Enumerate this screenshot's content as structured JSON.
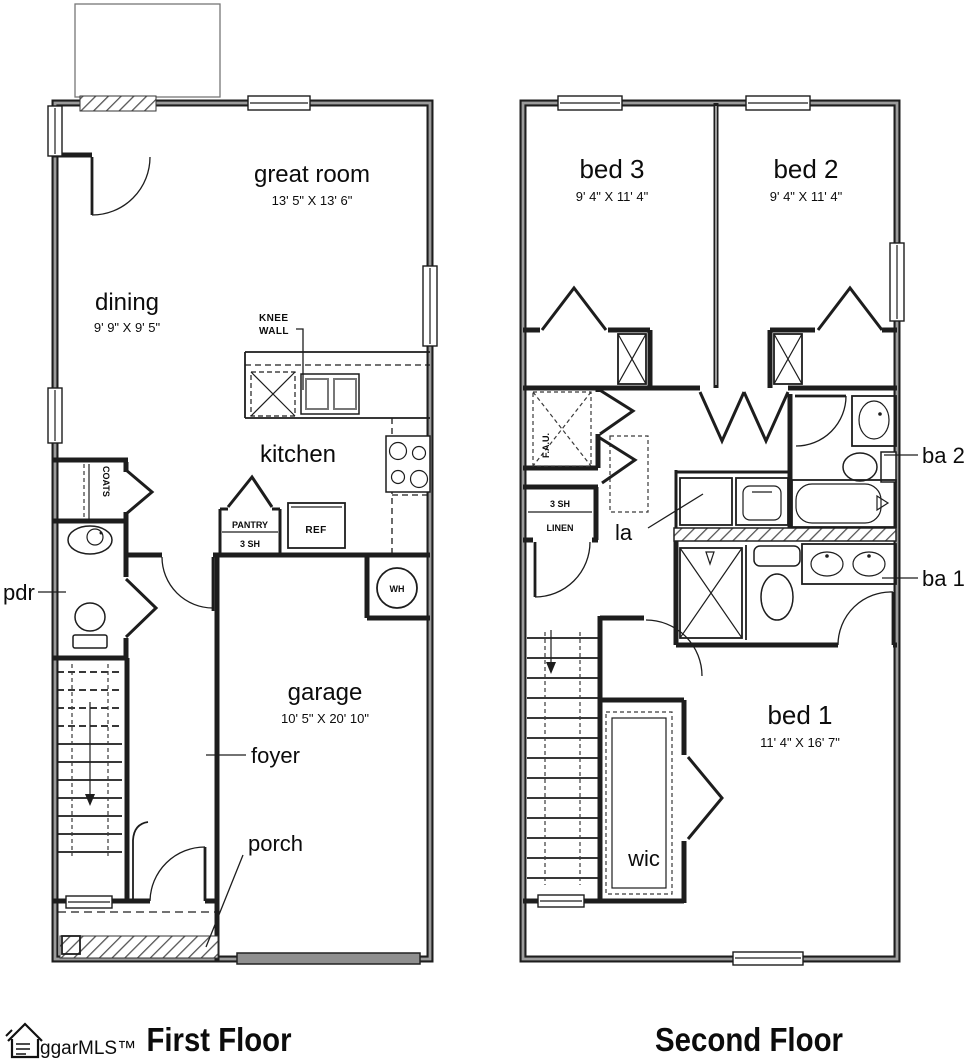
{
  "first_floor": {
    "title": "First Floor",
    "great_room": {
      "name": "great room",
      "dims": "13' 5\" X 13' 6\""
    },
    "dining": {
      "name": "dining",
      "dims": "9' 9\" X 9' 5\""
    },
    "kitchen": {
      "name": "kitchen"
    },
    "garage": {
      "name": "garage",
      "dims": "10' 5\" X 20' 10\""
    },
    "foyer": {
      "name": "foyer"
    },
    "porch": {
      "name": "porch"
    },
    "pdr": {
      "name": "pdr"
    },
    "knee_wall": [
      "KNEE",
      "WALL"
    ],
    "coats": "COATS",
    "pantry": [
      "PANTRY",
      "3 SH"
    ],
    "ref": "REF",
    "wh": "WH"
  },
  "second_floor": {
    "title": "Second Floor",
    "bed_3": {
      "name": "bed 3",
      "dims": "9' 4\" X 11' 4\""
    },
    "bed_2": {
      "name": "bed 2",
      "dims": "9' 4\" X 11' 4\""
    },
    "bed_1": {
      "name": "bed 1",
      "dims": "11' 4\" X 16' 7\""
    },
    "wic": {
      "name": "wic"
    },
    "ba_2": {
      "name": "ba 2"
    },
    "ba_1": {
      "name": "ba 1"
    },
    "laundry": {
      "name": "la"
    },
    "fau": "F.A.U.",
    "linen": [
      "3 SH",
      "LINEN"
    ]
  },
  "branding": {
    "logo_text": "ggarMLS™"
  },
  "colors": {
    "wall": "#1d1d1d",
    "background": "#ffffff",
    "hatch": "#555555",
    "garage_door": "#8f8f8f"
  }
}
